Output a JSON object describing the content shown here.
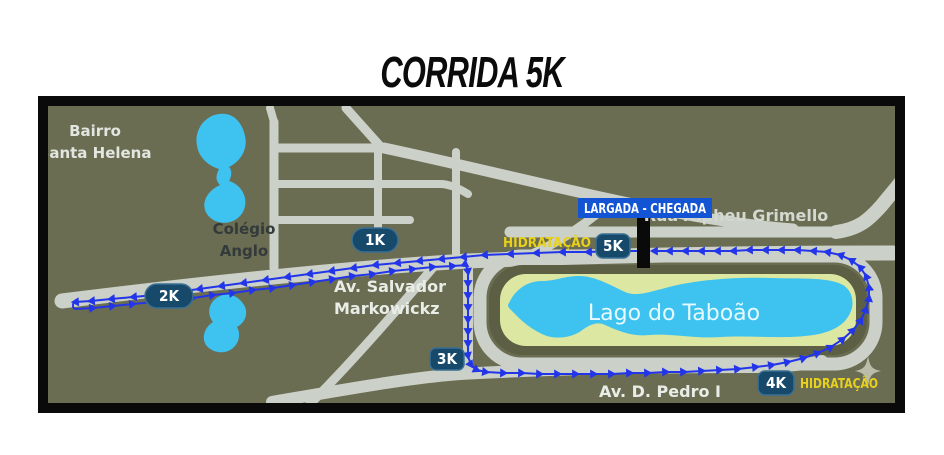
{
  "title": "CORRIDA 5K",
  "map": {
    "labels": {
      "bairro_line1": "Bairro",
      "bairro_line2": "Santa Helena",
      "colegio_line1": "Colégio",
      "colegio_line2": "Anglo",
      "av_salvador_line1": "Av. Salvador",
      "av_salvador_line2": "Markowickz",
      "rua_alpheu": "Rua Alpheu Grimello",
      "av_pedro": "Av. D. Pedro I",
      "lago": "Lago do Taboão"
    },
    "markers": {
      "k1": "1K",
      "k2": "2K",
      "k3": "3K",
      "k4": "4K",
      "k5": "5K",
      "largada": "LARGADA - CHEGADA",
      "hidratacao1": "HIDRATAÇÃO",
      "hidratacao2": "HIDRATAÇÃO"
    },
    "icons": {
      "sparkle": "four-pointed-star"
    },
    "colors": {
      "background": "#6b6d52",
      "road": "#cbd1c9",
      "water": "#3ec2f0",
      "park": "#dce8a2",
      "park_ring": "#5d5f45",
      "route": "#2335e8",
      "km_badge": "#17496b",
      "km_badge_border": "#3a6f93",
      "largada_box": "#1254d4",
      "hydration_text": "#e9d11b",
      "street_text": "#e9ede7",
      "dark_text": "#333a3b",
      "lake_text": "#e6fbff",
      "sparkle": "#b9bda9"
    }
  }
}
